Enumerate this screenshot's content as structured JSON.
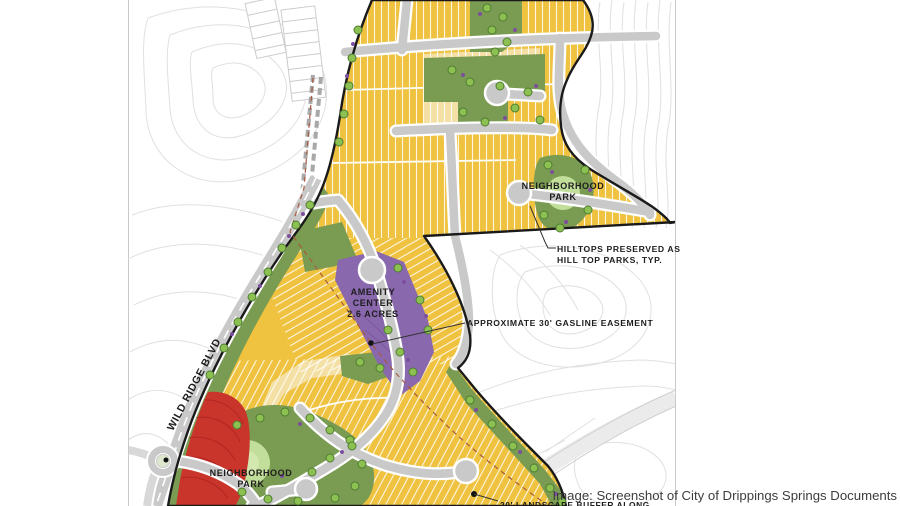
{
  "image": {
    "caption": "Image: Screenshot of City of Drippings Springs Documents"
  },
  "map": {
    "street_label": "WILD RIDGE BLVD",
    "labels": {
      "neighborhood_park_upper_line1": "NEIGHBORHOOD",
      "neighborhood_park_upper_line2": "PARK",
      "neighborhood_park_lower_line1": "NEIGHBORHOOD",
      "neighborhood_park_lower_line2": "PARK",
      "hilltops_line1": "HILLTOPS PRESERVED AS",
      "hilltops_line2": "HILL TOP PARKS, TYP.",
      "gasline_easement": "APPROXIMATE 30' GASLINE EASEMENT",
      "amenity_line1": "AMENITY",
      "amenity_line2": "CENTER",
      "amenity_line3": "2.6 ACRES",
      "landscape_buffer_partial": "20' LANDSCAPE BUFFER ALONG"
    },
    "legend_colors": {
      "residential_lots": "#EFC23F",
      "residential_lots_pale": "#F4E0A4",
      "park_green": "#7A9B52",
      "park_circle_light": "#C2DE9B",
      "tree_green": "#8CC152",
      "amenity_purple": "#8A68AE",
      "steep_slope_red": "#C9342B",
      "road_gray": "#C9C9C9",
      "boundary_black": "#1A1A1A",
      "contour_gray": "#E0E0E0"
    }
  }
}
